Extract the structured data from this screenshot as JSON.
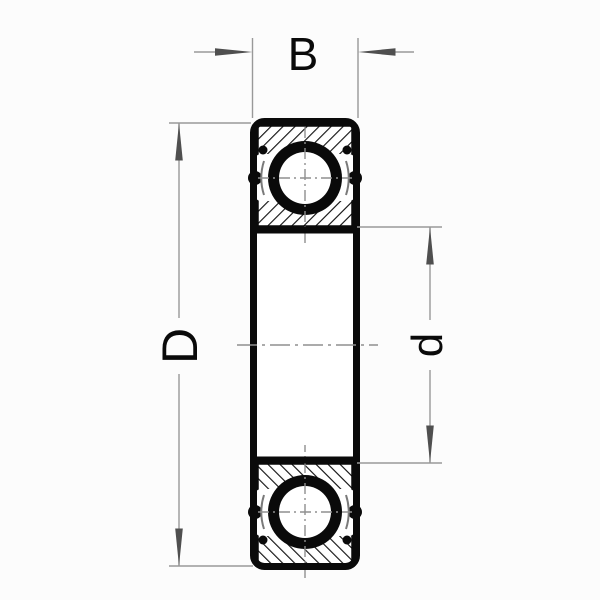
{
  "diagram": {
    "type": "technical-drawing",
    "subject": "deep-groove ball bearing cross-section with dimension callouts",
    "dimension_labels": {
      "width": "B",
      "outer_diameter": "D",
      "bore_diameter": "d"
    },
    "colors": {
      "ink": "#0a0a0a",
      "fill_white": "#ffffff",
      "dimension_line": "#999999",
      "arrowhead": "#4f4f4f",
      "center_line": "#8f8f8f",
      "cage_line": "#7a7a7a",
      "background": "#fcfcfc"
    }
  }
}
